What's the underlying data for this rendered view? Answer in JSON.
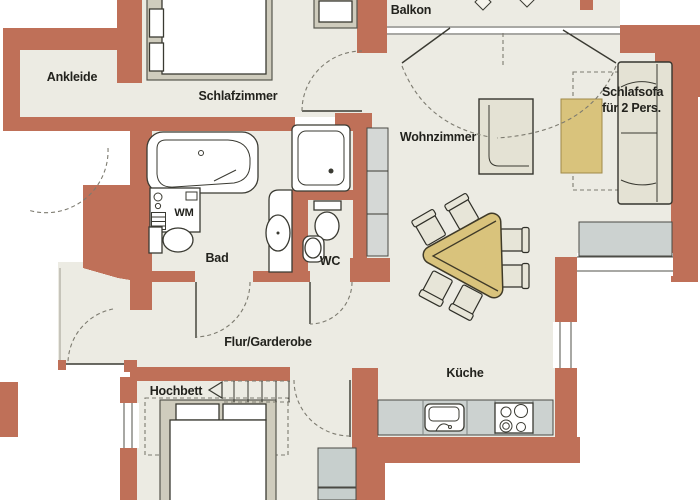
{
  "plan": {
    "rooms": {
      "ankleide": "Ankleide",
      "schlafzimmer": "Schlafzimmer",
      "balkon": "Balkon",
      "wohnzimmer": "Wohnzimmer",
      "bad": "Bad",
      "wc": "WC",
      "flur_garderobe": "Flur/Garderobe",
      "kueche": "Küche",
      "hochbett": "Hochbett"
    },
    "furniture_labels": {
      "waschmaschine": "WM",
      "schlafsofa_line1": "Schlafsofa",
      "schlafsofa_line2": "für 2 Pers."
    },
    "colors": {
      "wall": "#bf7058",
      "floor": "#ecebe3",
      "outline": "#3a3a32",
      "table_wood": "#d9c37c",
      "counter": "#ccd2d0",
      "furniture_frame": "#cfccbd",
      "upholstery": "#e4e2d4"
    }
  }
}
